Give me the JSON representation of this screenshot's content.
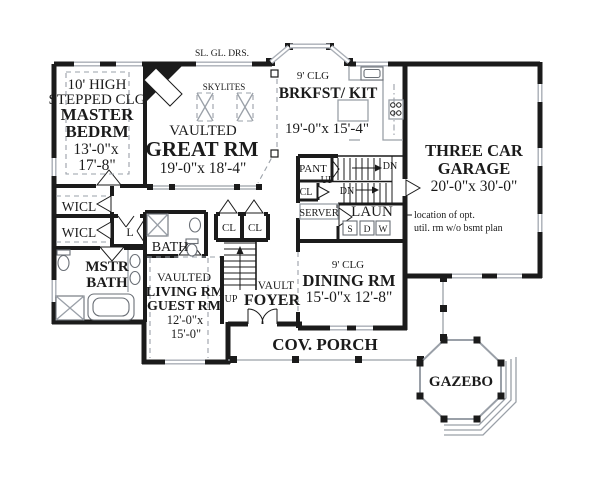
{
  "document": {
    "type": "house floor plan",
    "first_floor": true
  },
  "colors": {
    "wall": "#1b1b1b",
    "light_line": "#9aa0a8",
    "window": "#a9aeb6",
    "background": "#ffffff"
  },
  "labels": {
    "sliding_doors": "SL. GL. DRS.",
    "master_ceiling1": "10' HIGH",
    "master_ceiling2": "STEPPED CLG",
    "master_name1": "MASTER",
    "master_name2": "BEDRM",
    "master_dim1": "13'-0\"x",
    "master_dim2": "17'-8\"",
    "skylights": "SKYLITES",
    "great_vaulted": "VAULTED",
    "great_name": "GREAT RM",
    "great_dims": "19'-0\"x 18'-4\"",
    "brkfst_ceiling": "9' CLG",
    "brkfst_name": "BRKFST/ KIT",
    "brkfst_dims": "19'-0\"x 15'-4\"",
    "garage_name1": "THREE CAR",
    "garage_name2": "GARAGE",
    "garage_dims": "20'-0\"x 30'-0\"",
    "pantry": "PANT",
    "stair_up": "UP",
    "stair_dn_upper": "DN",
    "stair_closet": "CL",
    "stair_dn_lower": "DN",
    "server": "SERVER",
    "laundry": "LAUN",
    "laundry_s": "S",
    "laundry_d": "D",
    "laundry_w": "W",
    "note_line1": "location of opt.",
    "note_line2": "util. rm w/o bsmt plan",
    "wicl1": "WICL",
    "wicl2": "WICL",
    "linen": "L",
    "hall_bath": "BATH",
    "mstr_bath1": "MSTR",
    "mstr_bath2": "BATH",
    "foyer_cl1": "CL",
    "foyer_cl2": "CL",
    "foyer_up": "UP",
    "foyer_vault": "VAULT",
    "foyer_name": "FOYER",
    "living_vaulted": "VAULTED",
    "living_name1": "LIVING RM",
    "living_name2": "GUEST RM",
    "living_dim1": "12'-0\"x",
    "living_dim2": "15'-0\"",
    "dining_ceiling": "9' CLG",
    "dining_name": "DINING RM",
    "dining_dims": "15'-0\"x 12'-8\"",
    "porch": "COV. PORCH",
    "gazebo": "GAZEBO"
  }
}
